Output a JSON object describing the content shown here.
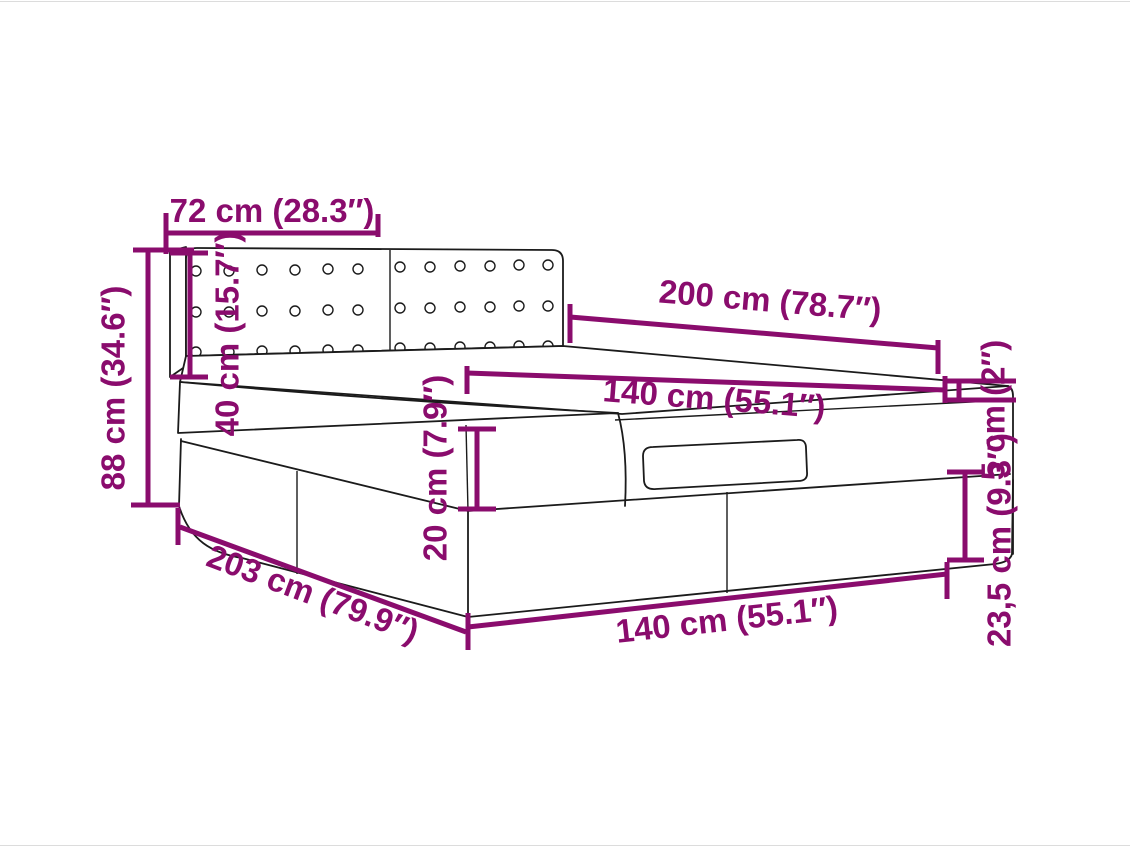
{
  "diagram": {
    "subject": "ottoman-bed-dimension-diagram",
    "accent_color": "#8A0C6D",
    "line_color": "#1B1B1B",
    "background_color": "#FFFFFF",
    "dims": {
      "headboard_width": "72 cm (28.3″)",
      "headboard_height": "40 cm (15.7″)",
      "total_height": "88 cm (34.6″)",
      "bed_length": "200 cm (78.7″)",
      "mattress_width": "140 cm (55.1″)",
      "topper_thickness": "5 cm (2″)",
      "upper_base_height": "20 cm (7.9″)",
      "lower_base_height": "23,5 cm (9.3″)",
      "base_length": "203 cm (79.9″)",
      "base_width": "140 cm (55.1″)"
    }
  }
}
